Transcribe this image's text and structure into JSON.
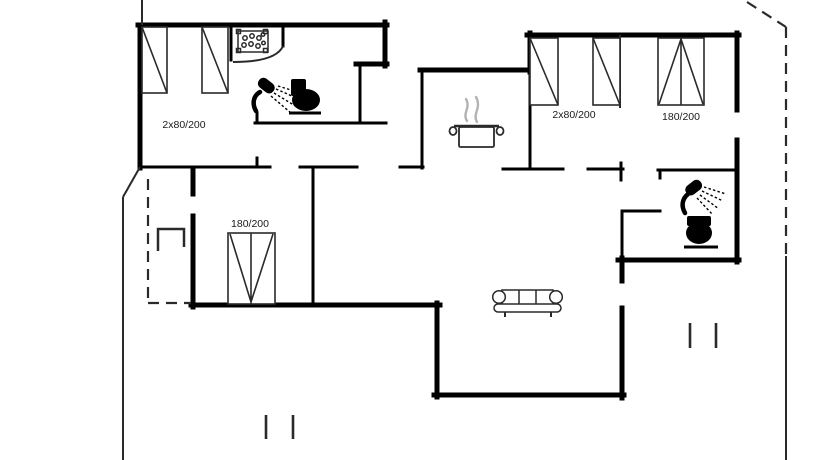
{
  "page": {
    "background": "#ffffff",
    "line_color": "#000000",
    "steam_color": "#b3b3b3",
    "label_color": "#1a1a1a"
  },
  "labels": {
    "bedroom_top_left_beds": "2x80/200",
    "bedroom_top_right_beds": "2x80/200",
    "bedroom_right_double_bed": "180/200",
    "bedroom_bottom_left_double_bed": "180/200"
  },
  "icons": {
    "single_bed": "narrow rectangle with diagonal",
    "double_bed": "wide rectangle with center line and V diagonals",
    "washbasin": "rectangle with dot cluster",
    "shower": "shower head with spray dashes",
    "toilet": "black toilet silhouette",
    "cooking_pot": "pot with steam",
    "sofa": "three-seat couch with scroll arms",
    "window_marker": "short double tick",
    "plot_boundary": "thin solid line",
    "overhang": "dashed line"
  }
}
